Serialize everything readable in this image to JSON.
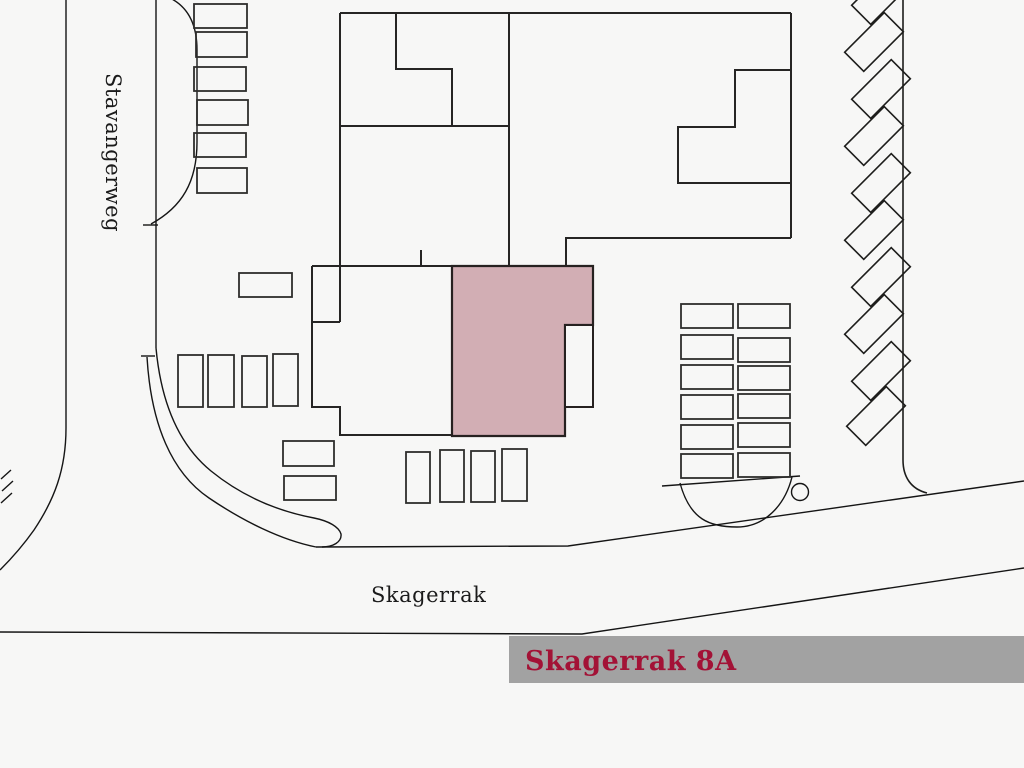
{
  "labels": {
    "street_vertical": "Stavangerweg",
    "street_horizontal": "Skagerrak",
    "banner": "Skagerrak 8A"
  },
  "colors": {
    "background": "#f7f7f6",
    "line": "#1d1d1b",
    "label_text": "#1b1b1b",
    "highlight_building": "#d2aeb4",
    "highlight_parking": "#ecd9da",
    "banner_bg": "#a2a2a2",
    "banner_text": "#a31236"
  }
}
